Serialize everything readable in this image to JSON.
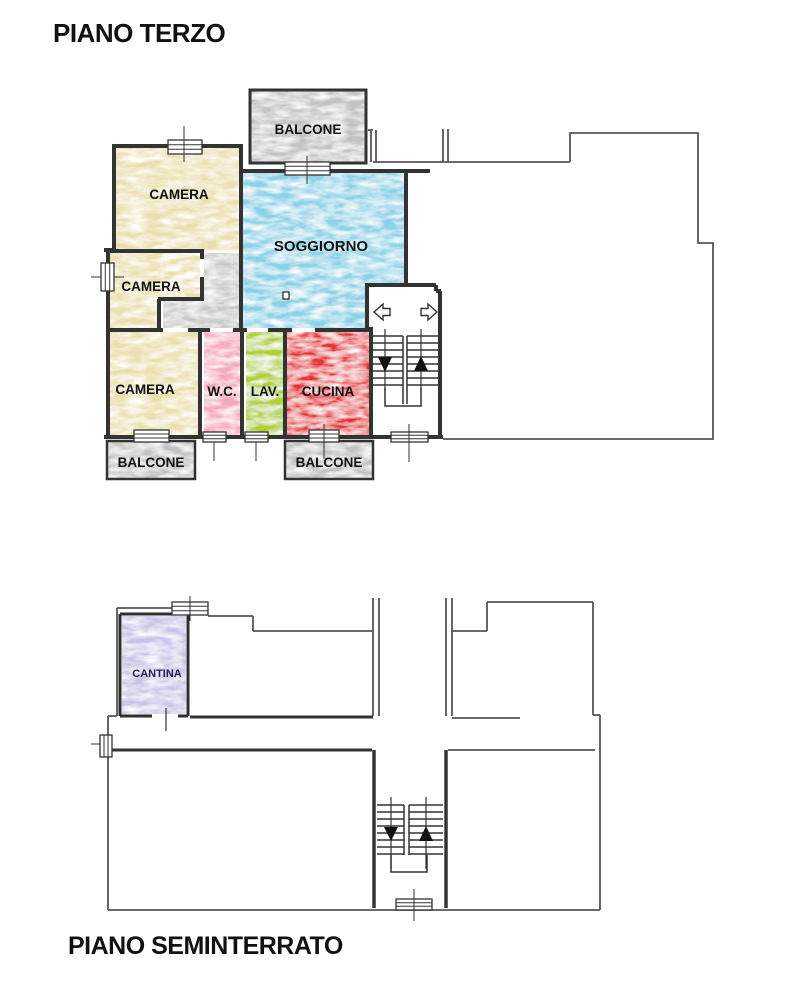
{
  "upper_floor": {
    "title": "PIANO TERZO",
    "rooms": {
      "balcone_top": {
        "label": "BALCONE",
        "color": "#c2c2c2"
      },
      "camera_top": {
        "label": "CAMERA",
        "color": "#ecdfae"
      },
      "camera_mid": {
        "label": "CAMERA",
        "color": "#ecdfae"
      },
      "camera_bottom": {
        "label": "CAMERA",
        "color": "#ecdfae"
      },
      "soggiorno": {
        "label": "SOGGIORNO",
        "color": "#8ad2e8"
      },
      "corridoio": {
        "color": "#c8c8c8"
      },
      "wc": {
        "label": "W.C.",
        "color": "#f6a8c0"
      },
      "lav": {
        "label": "LAV.",
        "color": "#b0d12f"
      },
      "cucina": {
        "label": "CUCINA",
        "color": "#e83238"
      },
      "balcone_bottom_left": {
        "label": "BALCONE",
        "color": "#c2c2c2"
      },
      "balcone_bottom_right": {
        "label": "BALCONE",
        "color": "#c2c2c2"
      }
    },
    "icons": {
      "stairs_down": "triangle-down",
      "stairs_up": "triangle-up",
      "exit_left": "outline-arrow-left",
      "exit_right": "outline-arrow-right"
    }
  },
  "lower_floor": {
    "title": "PIANO SEMINTERRATO",
    "rooms": {
      "cantina": {
        "label": "CANTINA",
        "color": "#c8c2e8",
        "label_color": "#1d1d4f"
      }
    },
    "icons": {
      "stairs_down": "triangle-down",
      "stairs_up": "triangle-up"
    }
  },
  "wall_color": "#333333",
  "outline_color": "#555555",
  "label_color": "#111111"
}
